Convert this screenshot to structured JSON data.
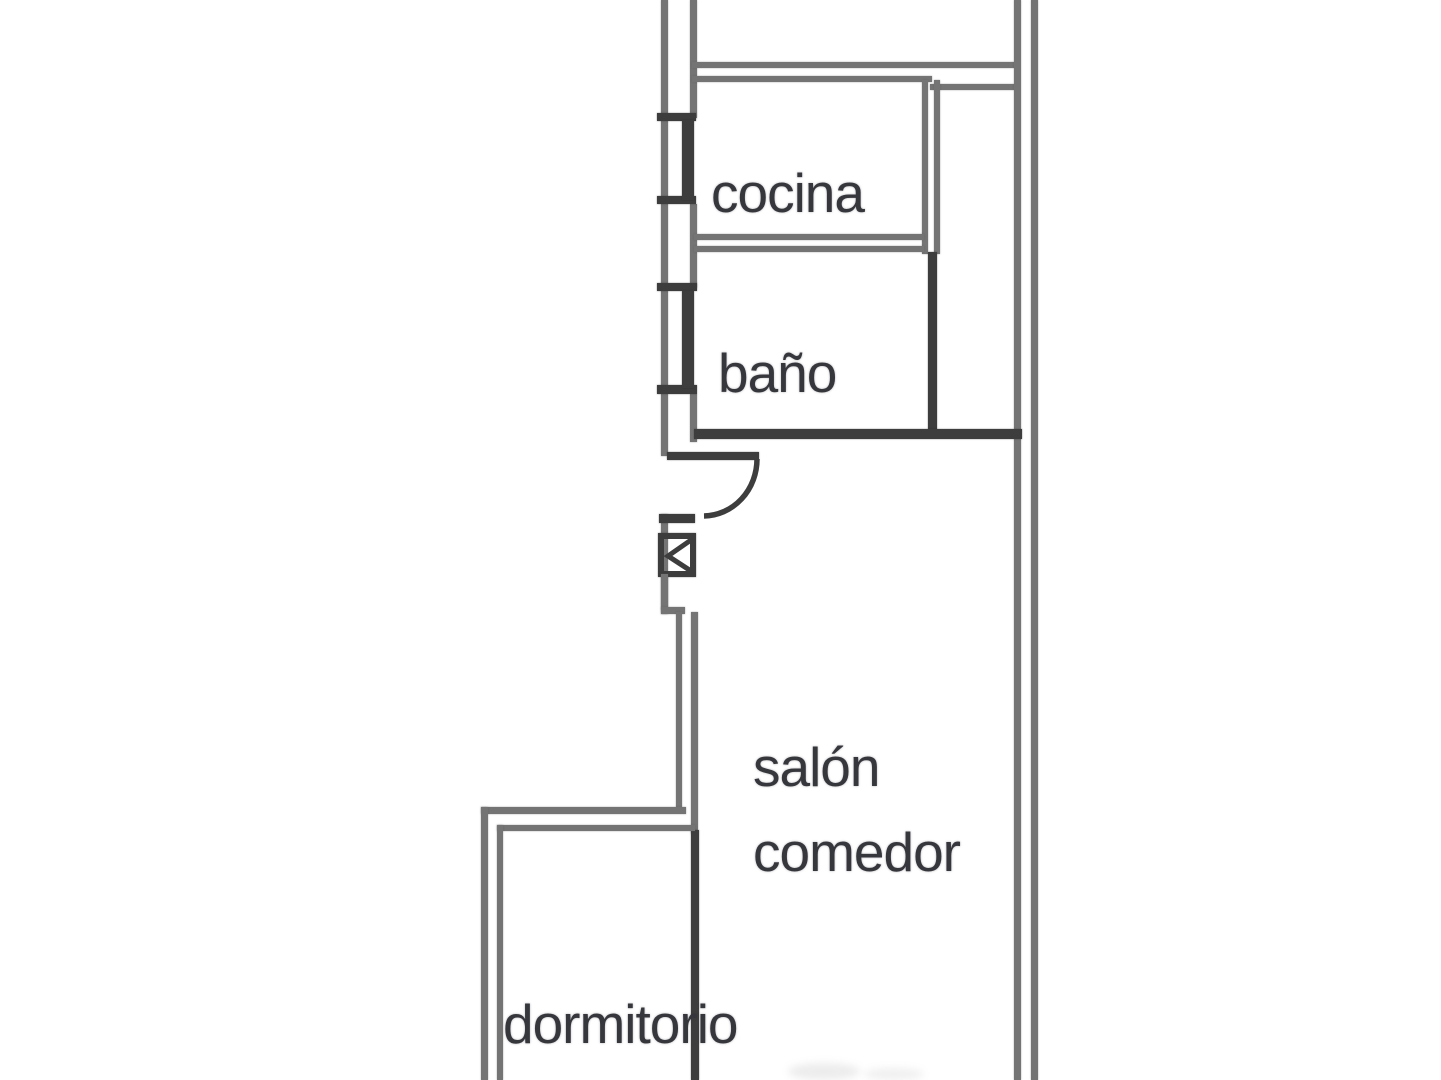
{
  "diagram": {
    "type": "floor-plan",
    "language": "es",
    "rooms": {
      "cocina": {
        "label": "cocina"
      },
      "bano": {
        "label": "baño"
      },
      "salon_comedor": {
        "label_line1": "salón",
        "label_line2": "comedor"
      },
      "dormitorio": {
        "label": "dormitorio"
      }
    },
    "symbols": {
      "window": "window-icon",
      "door": "door-swing-icon",
      "shaft": "shaft-box-icon"
    },
    "colors": {
      "wall": "#747474",
      "wall_dark": "#3d3d3d",
      "text": "#36363d",
      "background": "#ffffff"
    }
  }
}
